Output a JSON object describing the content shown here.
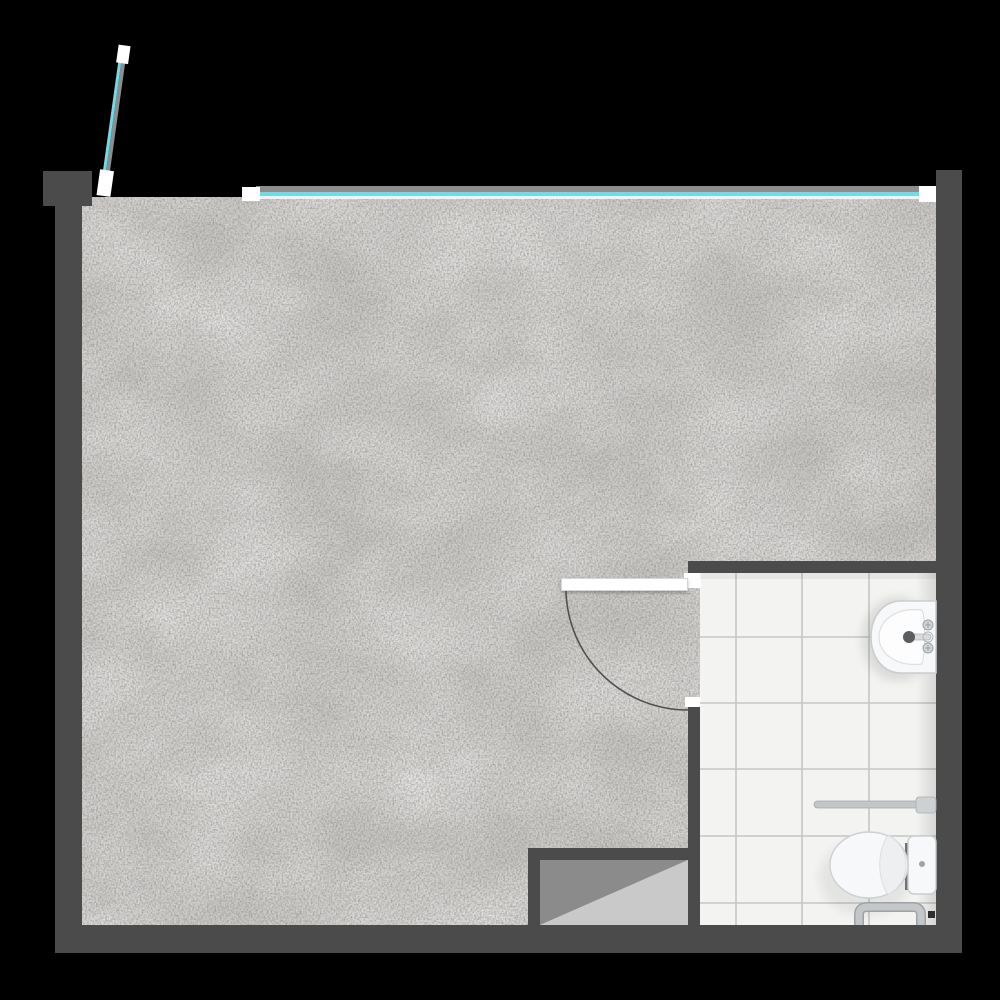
{
  "meta": {
    "type": "floor-plan",
    "description": "Top-down architectural floor plan of a studio room with concrete floor and a tiled bathroom in the lower-right corner"
  },
  "colors": {
    "background": "#000000",
    "wall": "#4b4b4b",
    "concrete_floor": "#c8c6c3",
    "tile_floor": "#f3f3f1",
    "tile_grout": "#c6c6c5",
    "window_glass_teal": "#74d9e7",
    "window_frame_gray": "#8d8d8d",
    "window_cap_white": "#ffffff",
    "fixture_white": "#f7f8f9",
    "fixture_stroke": "#c9cdd0",
    "metal_gray": "#c0c3c5",
    "shaft_dark_triangle": "#8b8b8b",
    "shaft_light_triangle": "#c9c9c9",
    "door_arc": "#4f4f4f"
  },
  "rooms": [
    {
      "name": "main room",
      "floor": "concrete"
    },
    {
      "name": "bathroom",
      "floor": "white tile",
      "tile_columns": 4,
      "tile_rows": 6
    }
  ],
  "elements": {
    "windows": [
      {
        "name": "slanted window",
        "location": "top-left, tilted out of plan"
      },
      {
        "name": "ribbon window",
        "location": "full top wall"
      }
    ],
    "door": {
      "name": "bathroom swing door",
      "swing": "quarter-circle arc opening into main room"
    },
    "fixtures": [
      {
        "name": "wall-hung sink",
        "location": "bathroom right wall, upper"
      },
      {
        "name": "toilet with tank",
        "location": "bathroom right wall, lower"
      },
      {
        "name": "grab bar",
        "location": "above toilet on right wall"
      },
      {
        "name": "towel rail",
        "location": "bottom wall of bathroom"
      }
    ],
    "shaft": {
      "name": "shaft niche",
      "symbol": "diagonal split rectangle",
      "location": "bottom center between rooms"
    }
  }
}
